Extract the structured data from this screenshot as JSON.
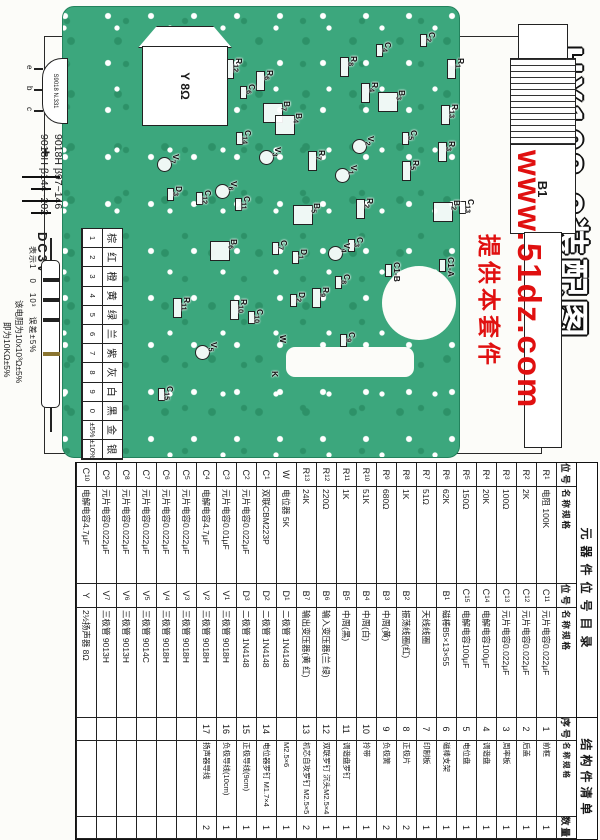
{
  "title": "HX108-2装配图",
  "watermark": {
    "line1": "www.51dz.com",
    "line2": "提供本套件",
    "color": "#e01010"
  },
  "pcb": {
    "board_color": "#3ca77d",
    "speaker_label": "Y 8Ω",
    "battery_plus": "+",
    "battery_label": "DC3V",
    "antenna_label": "B1",
    "labels": [
      {
        "t": "R12",
        "x": 58,
        "y": 356
      },
      {
        "t": "C6",
        "x": 84,
        "y": 343
      },
      {
        "t": "R6",
        "x": 70,
        "y": 325
      },
      {
        "t": "B7",
        "x": 101,
        "y": 308
      },
      {
        "t": "B4",
        "x": 113,
        "y": 296
      },
      {
        "t": "R8",
        "x": 56,
        "y": 241
      },
      {
        "t": "C4",
        "x": 42,
        "y": 207
      },
      {
        "t": "C2",
        "x": 32,
        "y": 163
      },
      {
        "t": "R1",
        "x": 58,
        "y": 134
      },
      {
        "t": "R4",
        "x": 82,
        "y": 220
      },
      {
        "t": "B3",
        "x": 90,
        "y": 193
      },
      {
        "t": "R13",
        "x": 104,
        "y": 140
      },
      {
        "t": "C14",
        "x": 130,
        "y": 347
      },
      {
        "t": "V3",
        "x": 147,
        "y": 317
      },
      {
        "t": "V7",
        "x": 154,
        "y": 419
      },
      {
        "t": "C12",
        "x": 190,
        "y": 387
      },
      {
        "t": "D3",
        "x": 186,
        "y": 416
      },
      {
        "t": "V6",
        "x": 181,
        "y": 361
      },
      {
        "t": "C11",
        "x": 196,
        "y": 348
      },
      {
        "t": "C5",
        "x": 130,
        "y": 181
      },
      {
        "t": "V2",
        "x": 136,
        "y": 224
      },
      {
        "t": "R3",
        "x": 141,
        "y": 143
      },
      {
        "t": "R5",
        "x": 160,
        "y": 179
      },
      {
        "t": "V1",
        "x": 165,
        "y": 241
      },
      {
        "t": "R7",
        "x": 150,
        "y": 273
      },
      {
        "t": "B5",
        "x": 203,
        "y": 278
      },
      {
        "t": "R2",
        "x": 198,
        "y": 225
      },
      {
        "t": "B2",
        "x": 200,
        "y": 138
      },
      {
        "t": "C13",
        "x": 199,
        "y": 124
      },
      {
        "t": "B6",
        "x": 239,
        "y": 361
      },
      {
        "t": "C7",
        "x": 240,
        "y": 311
      },
      {
        "t": "D1",
        "x": 249,
        "y": 291
      },
      {
        "t": "V4",
        "x": 243,
        "y": 248
      },
      {
        "t": "C3",
        "x": 237,
        "y": 235
      },
      {
        "t": "C8",
        "x": 274,
        "y": 248
      },
      {
        "t": "R9",
        "x": 287,
        "y": 269
      },
      {
        "t": "R11",
        "x": 297,
        "y": 408
      },
      {
        "t": "R10",
        "x": 299,
        "y": 351
      },
      {
        "t": "C10",
        "x": 309,
        "y": 335
      },
      {
        "t": "D2",
        "x": 292,
        "y": 293
      },
      {
        "t": "V5",
        "x": 342,
        "y": 381
      },
      {
        "t": "W",
        "x": 335,
        "y": 312
      },
      {
        "t": "C15",
        "x": 386,
        "y": 425
      },
      {
        "t": "K",
        "x": 371,
        "y": 320
      },
      {
        "t": "C9",
        "x": 332,
        "y": 243
      },
      {
        "t": "C1-B",
        "x": 262,
        "y": 198
      },
      {
        "t": "C1-A",
        "x": 257,
        "y": 144
      }
    ]
  },
  "transistor_legend": {
    "line1": "9018H β97~146",
    "line2": "9013H β144~202",
    "body": "S9018 N.331",
    "pins": [
      "e",
      "b",
      "c"
    ]
  },
  "color_code": {
    "title": "色环电阻色标数",
    "colors": [
      "棕",
      "红",
      "橙",
      "黄",
      "绿",
      "兰",
      "紫",
      "灰",
      "白",
      "黑",
      "金",
      "银"
    ],
    "values": [
      "1",
      "2",
      "3",
      "4",
      "5",
      "6",
      "7",
      "8",
      "9",
      "0",
      "±5%",
      "±10%"
    ],
    "example_prefix": "例：",
    "example_bands": "棕 黑 橙 金",
    "annotations": "表示1　0　10³　误差±5%",
    "note1": "该电阻为10x10³Ω±5%",
    "note2": "即为10KΩ±5%"
  },
  "parts_table": {
    "title": "元器件位号目录",
    "struct_title": "结构件清单",
    "headers": [
      "位号",
      "名称规格",
      "位号",
      "名称规格",
      "序号",
      "名称规格",
      "数量"
    ],
    "rows": [
      [
        "R1",
        "电阻 100K",
        "C11",
        "元片电容0.022μF",
        "1",
        "前框",
        "1"
      ],
      [
        "R2",
        "2K",
        "C12",
        "元片电容0.022μF",
        "2",
        "后盖",
        "1"
      ],
      [
        "R3",
        "100Ω",
        "C13",
        "元片电容0.022μF",
        "3",
        "周率板",
        "1"
      ],
      [
        "R4",
        "20K",
        "C14",
        "电解电容100μF",
        "4",
        "调谐盘",
        "1"
      ],
      [
        "R5",
        "150Ω",
        "C15",
        "电解电容100μF",
        "5",
        "电位盘",
        "1"
      ],
      [
        "R6",
        "62K",
        "B1",
        "磁棒B5×13×55",
        "6",
        "磁棒支架",
        "1"
      ],
      [
        "R7",
        "51Ω",
        "",
        "天线线圈",
        "7",
        "印制板",
        "1"
      ],
      [
        "R8",
        "1K",
        "B2",
        "振荡线圈(红)",
        "8",
        "正极片",
        "2"
      ],
      [
        "R9",
        "680Ω",
        "B3",
        "中周(黄)",
        "9",
        "负极簧",
        "2"
      ],
      [
        "R10",
        "51K",
        "B4",
        "中周(白)",
        "10",
        "拎带",
        "1"
      ],
      [
        "R11",
        "1K",
        "B5",
        "中周(黑)",
        "11",
        "调谐盘罗钉",
        "1"
      ],
      [
        "R12",
        "220Ω",
        "B6",
        "输入变压器(兰 绿)",
        "12",
        "双联罗钉 沉头M2.5×4",
        "1"
      ],
      [
        "R13",
        "24K",
        "B7",
        "输出变压器(黄 红)",
        "13",
        "机芯自攻罗钉 M2.5×5",
        "2"
      ],
      [
        "W",
        "电位器 5K",
        "D1",
        "二极管 1N4148",
        "",
        "M2.5×6",
        "1"
      ],
      [
        "C1",
        "双联CBM223P",
        "D2",
        "二极管 1N4148",
        "14",
        "电位器罗钉 M1.7×4",
        "1"
      ],
      [
        "C2",
        "元片电容0.022μF",
        "D3",
        "二极管 1N4148",
        "15",
        "正极导线(9cm)",
        "1"
      ],
      [
        "C3",
        "元片电容0.01μF",
        "V1",
        "三极管 9018H",
        "16",
        "负极导线(10cm)",
        "1"
      ],
      [
        "C4",
        "电解电容4.7μF",
        "V2",
        "三极管 9018H",
        "17",
        "扬声器导线",
        "2"
      ],
      [
        "C5",
        "元片电容0.022μF",
        "V3",
        "三极管 9018H",
        "",
        "",
        ""
      ],
      [
        "C6",
        "元片电容0.022μF",
        "V4",
        "三极管 9018H",
        "",
        "",
        ""
      ],
      [
        "C7",
        "元片电容0.022μF",
        "V5",
        "三极管 9014C",
        "",
        "",
        ""
      ],
      [
        "C8",
        "元片电容0.022μF",
        "V6",
        "三极管 9013H",
        "",
        "",
        ""
      ],
      [
        "C9",
        "元片电容0.022μF",
        "V7",
        "三极管 9013H",
        "",
        "",
        ""
      ],
      [
        "C10",
        "电解电容4.7μF",
        "Y",
        "2½扬声器 8Ω",
        "",
        "",
        ""
      ]
    ]
  }
}
